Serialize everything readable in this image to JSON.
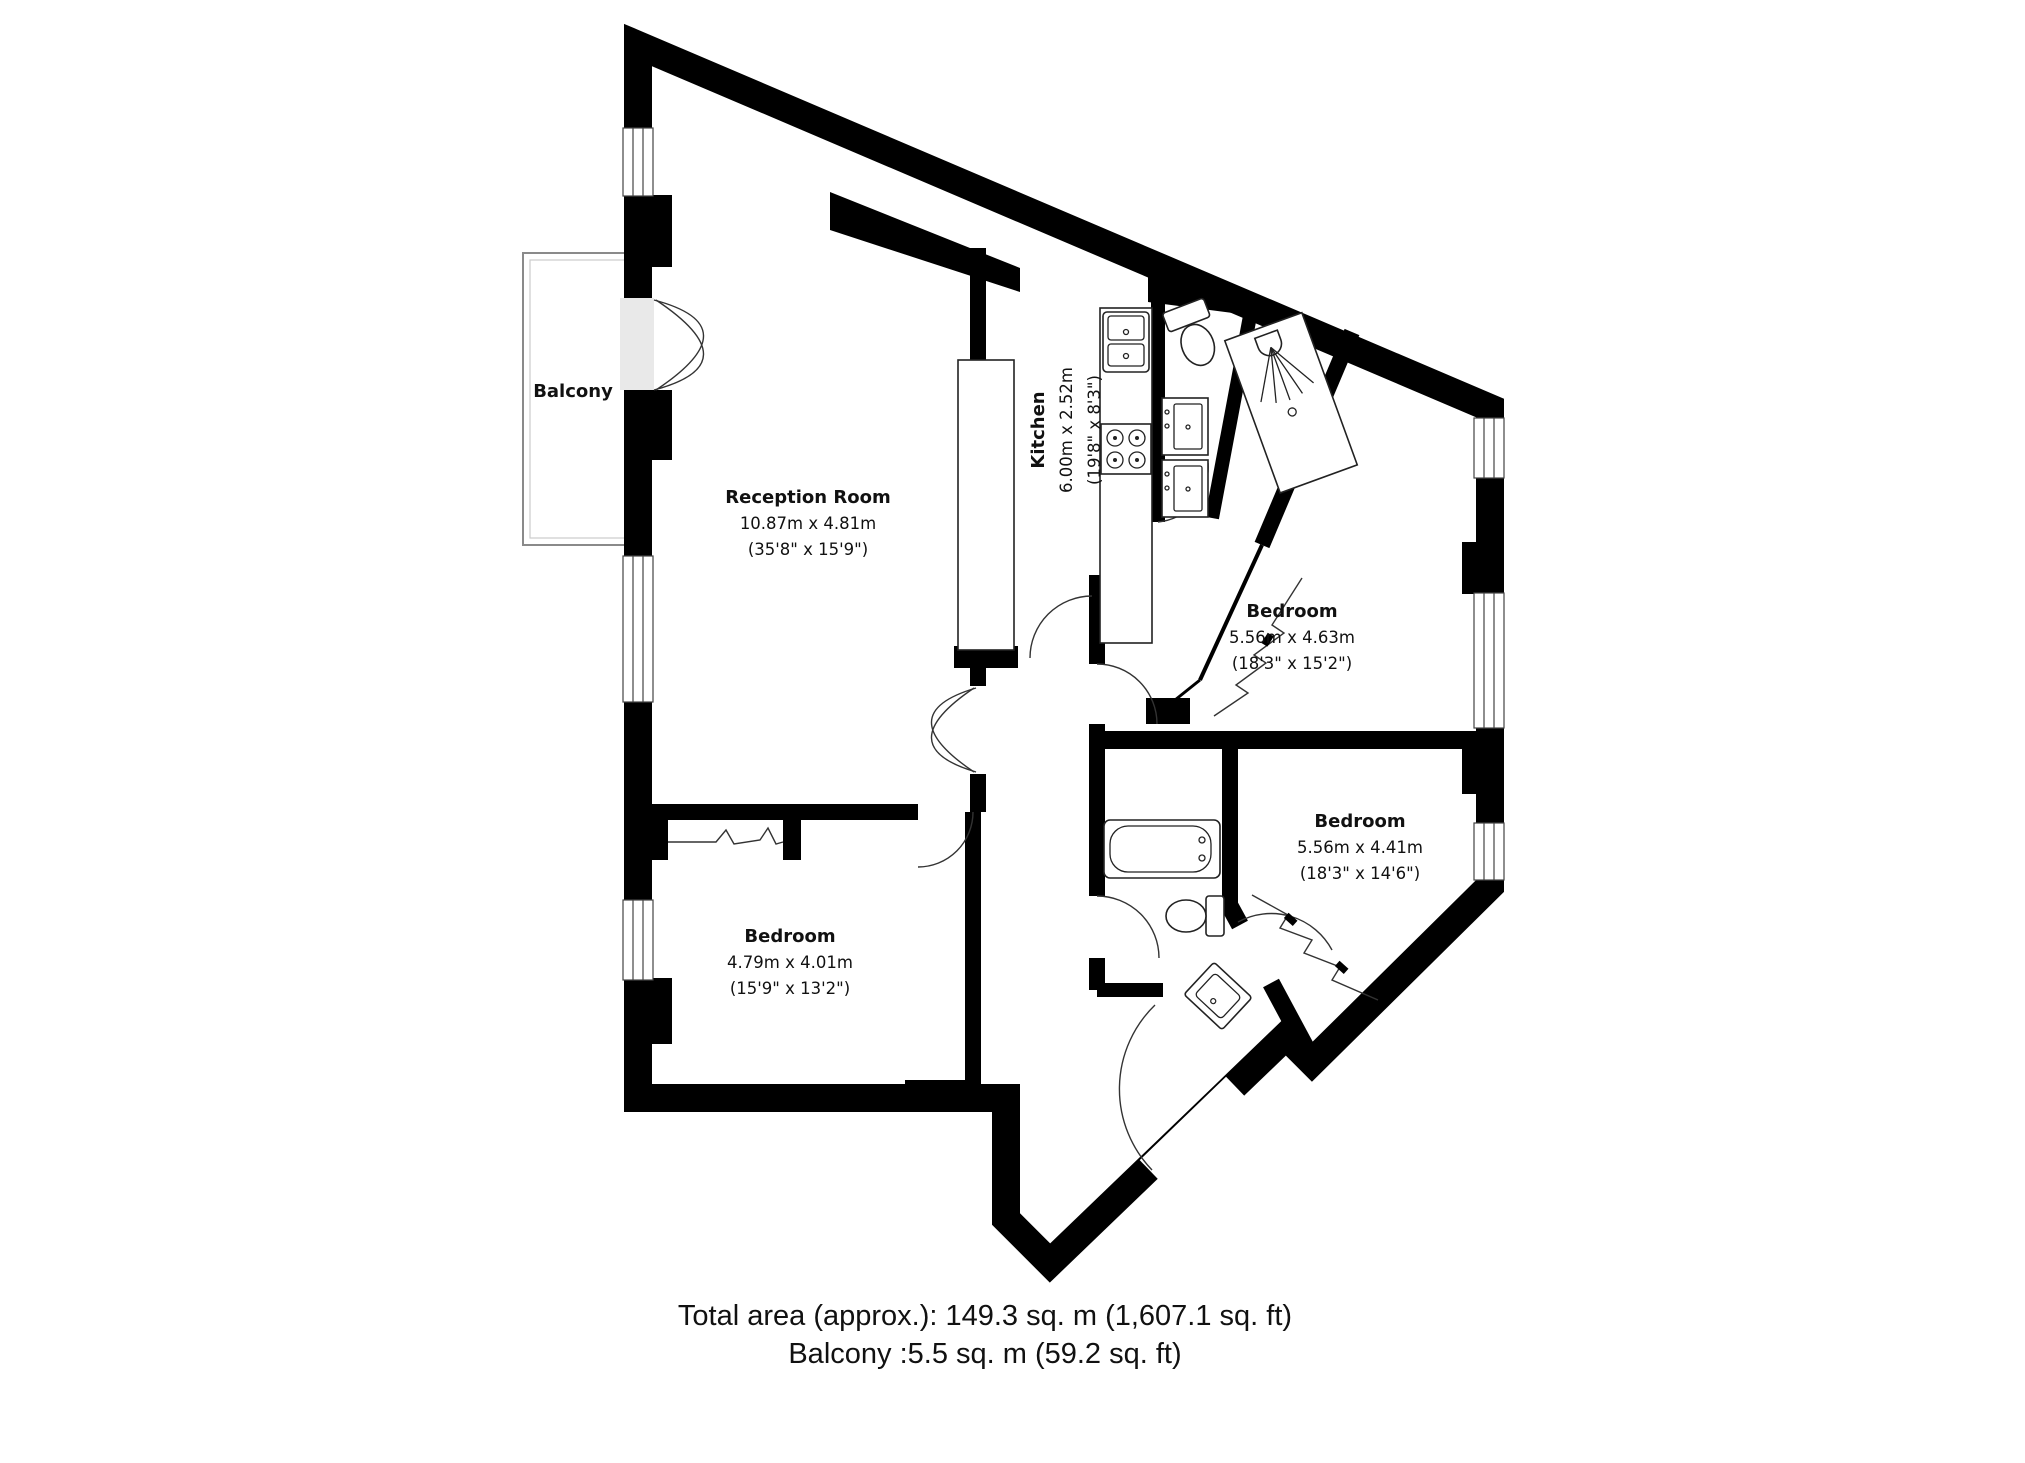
{
  "page": {
    "background": "#ffffff"
  },
  "plan": {
    "colors": {
      "floor": "#e9e9e9",
      "wall": "#000000",
      "fixture_stroke": "#222222",
      "balcony_stroke": "#8a8a8a"
    },
    "balcony": {
      "label": "Balcony"
    },
    "rooms": [
      {
        "name": "Reception Room",
        "dims_metric": "10.87m x 4.81m",
        "dims_imperial": "(35'8\" x 15'9\")"
      },
      {
        "name": "Kitchen",
        "dims_metric": "6.00m x 2.52m",
        "dims_imperial": "(19'8\" x 8'3\")"
      },
      {
        "name": "Bedroom",
        "dims_metric": "5.56m x 4.63m",
        "dims_imperial": "(18'3\" x 15'2\")"
      },
      {
        "name": "Bedroom",
        "dims_metric": "5.56m x 4.41m",
        "dims_imperial": "(18'3\" x 14'6\")"
      },
      {
        "name": "Bedroom",
        "dims_metric": "4.79m x 4.01m",
        "dims_imperial": "(15'9\" x 13'2\")"
      }
    ],
    "fixtures": [
      "bathtub",
      "toilet-wc",
      "toilet-bathroom",
      "shower",
      "basin-hall",
      "kitchen-sink",
      "hob",
      "oven-upper",
      "oven-lower",
      "wardrobe-bedroom-left",
      "wardrobe-bedroom-topright",
      "wardrobe-bedroom-bottomright"
    ],
    "footer": {
      "line1": "Total area (approx.): 149.3 sq. m (1,607.1 sq. ft)",
      "line2": "Balcony :5.5 sq. m (59.2 sq. ft)"
    }
  }
}
